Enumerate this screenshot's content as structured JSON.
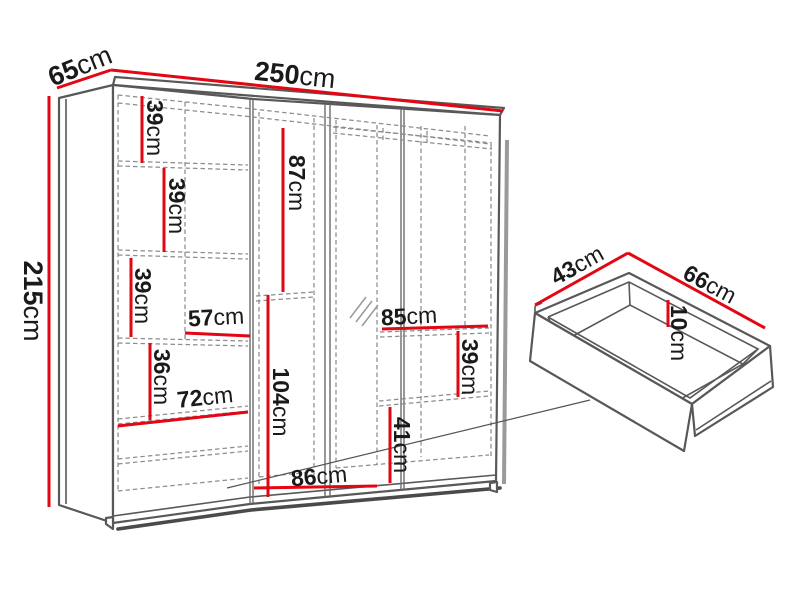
{
  "colors": {
    "dimension_line": "#e30613",
    "outline": "#585858",
    "dashed_line": "#8c8c8c",
    "label_text": "#1a1a1a",
    "background": "#ffffff"
  },
  "dims": {
    "height": {
      "value": "215",
      "unit": "cm"
    },
    "depth": {
      "value": "65",
      "unit": "cm"
    },
    "width": {
      "value": "250",
      "unit": "cm"
    },
    "left_top_shelf": {
      "value": "39",
      "unit": "cm"
    },
    "left_mid_shelf": {
      "value": "39",
      "unit": "cm"
    },
    "left_lower_shelf": {
      "value": "39",
      "unit": "cm"
    },
    "left_cubby_width": {
      "value": "57",
      "unit": "cm"
    },
    "left_lower_height": {
      "value": "36",
      "unit": "cm"
    },
    "left_bottom_width": {
      "value": "72",
      "unit": "cm"
    },
    "mid_upper_height": {
      "value": "87",
      "unit": "cm"
    },
    "mid_lower_height": {
      "value": "104",
      "unit": "cm"
    },
    "mid_bottom_width": {
      "value": "86",
      "unit": "cm"
    },
    "right_shelf_width": {
      "value": "85",
      "unit": "cm"
    },
    "right_cubby_height": {
      "value": "39",
      "unit": "cm"
    },
    "right_lower_height": {
      "value": "41",
      "unit": "cm"
    },
    "drawer_depth": {
      "value": "43",
      "unit": "cm"
    },
    "drawer_width": {
      "value": "66",
      "unit": "cm"
    },
    "drawer_height": {
      "value": "10",
      "unit": "cm"
    }
  }
}
